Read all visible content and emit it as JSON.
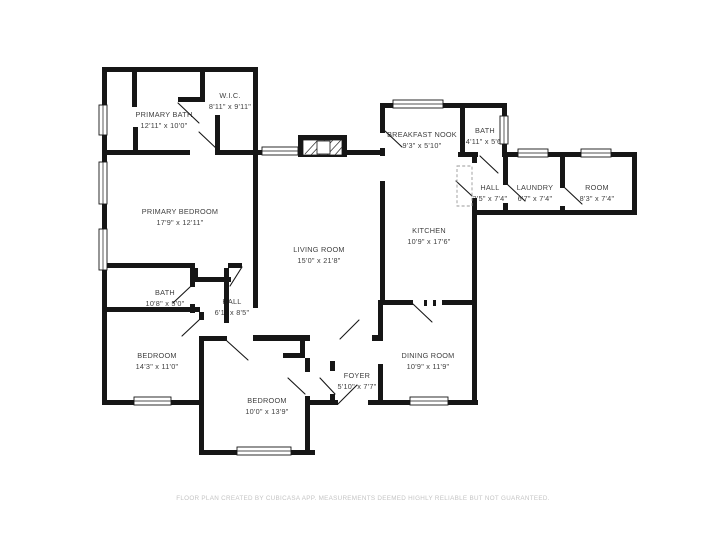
{
  "page": {
    "background": "#ffffff",
    "wall_color": "#161616",
    "label_color": "#3f3f3f",
    "footer_color": "#c4c4c4"
  },
  "footer": {
    "text": "FLOOR PLAN CREATED BY CUBICASA APP. MEASUREMENTS DEEMED HIGHLY RELIABLE BUT NOT GUARANTEED."
  },
  "rooms": [
    {
      "id": "primary-bath",
      "label": "PRIMARY BATH",
      "dims": "12'11\" x 10'0\""
    },
    {
      "id": "wic",
      "label": "W.I.C.",
      "dims": "8'11\" x 9'11\""
    },
    {
      "id": "primary-bedroom",
      "label": "PRIMARY BEDROOM",
      "dims": "17'9\" x 12'11\""
    },
    {
      "id": "bath-left",
      "label": "BATH",
      "dims": "10'8\" x 5'0\""
    },
    {
      "id": "hall-left",
      "label": "HALL",
      "dims": "6'1\" x 8'5\""
    },
    {
      "id": "bedroom-left",
      "label": "BEDROOM",
      "dims": "14'3\" x 11'0\""
    },
    {
      "id": "bedroom-bottom",
      "label": "BEDROOM",
      "dims": "10'0\" x 13'9\""
    },
    {
      "id": "living-room",
      "label": "LIVING ROOM",
      "dims": "15'0\" x 21'8\""
    },
    {
      "id": "foyer",
      "label": "FOYER",
      "dims": "5'10\" x 7'7\""
    },
    {
      "id": "dining-room",
      "label": "DINING ROOM",
      "dims": "10'9\" x 11'9\""
    },
    {
      "id": "kitchen",
      "label": "KITCHEN",
      "dims": "10'9\" x 17'6\""
    },
    {
      "id": "breakfast-nook",
      "label": "BREAKFAST NOOK",
      "dims": "9'3\" x 5'10\""
    },
    {
      "id": "bath-top",
      "label": "BATH",
      "dims": "4'11\" x 5'6\""
    },
    {
      "id": "hall-right",
      "label": "HALL",
      "dims": "3'5\" x 7'4\""
    },
    {
      "id": "laundry",
      "label": "LAUNDRY",
      "dims": "6'7\" x 7'4\""
    },
    {
      "id": "room",
      "label": "ROOM",
      "dims": "8'3\" x 7'4\""
    }
  ]
}
